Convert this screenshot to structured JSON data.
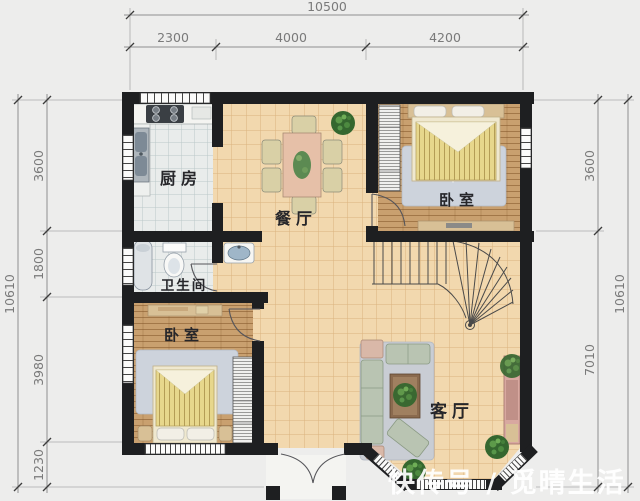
{
  "page": {
    "background": "#ededec",
    "type": "residential floor plan drawing"
  },
  "dimensions": {
    "top": {
      "total": "10500",
      "segments": [
        "2300",
        "4000",
        "4200"
      ]
    },
    "left": {
      "total": "10610",
      "segments": [
        "3600",
        "1800",
        "3980",
        "1230"
      ]
    },
    "right": {
      "total": "10610",
      "segments": [
        "3600",
        "7010"
      ]
    }
  },
  "rooms": {
    "kitchen": {
      "label": "厨房",
      "floor": "tile"
    },
    "dining": {
      "label": "餐厅",
      "floor": "ceramic"
    },
    "bedroom_right": {
      "label": "卧室",
      "floor": "wood"
    },
    "bathroom": {
      "label": "卫生间",
      "floor": "tile"
    },
    "bedroom_left": {
      "label": "卧室",
      "floor": "wood"
    },
    "living": {
      "label": "客厅",
      "floor": "ceramic"
    }
  },
  "features": {
    "staircase": "curved winder stair, middle right",
    "entrance": "double swing door, bottom center with porch columns",
    "bay": "chamfered corner windows, bottom right"
  },
  "watermark": {
    "text": "快传号 / 觅晴生活",
    "color": "#ffffff"
  },
  "colors": {
    "wall": "#1e1f21",
    "floor_ceramic": "#f2d8ae",
    "floor_wood": "#c9a06f",
    "floor_tile": "#e9ecec",
    "rug": "#cdd3dc",
    "bed_blanket": "#e7d78c",
    "sofa": "#b9c4b2",
    "plant": "#35672f",
    "dimension_text": "#7a7a7a"
  }
}
